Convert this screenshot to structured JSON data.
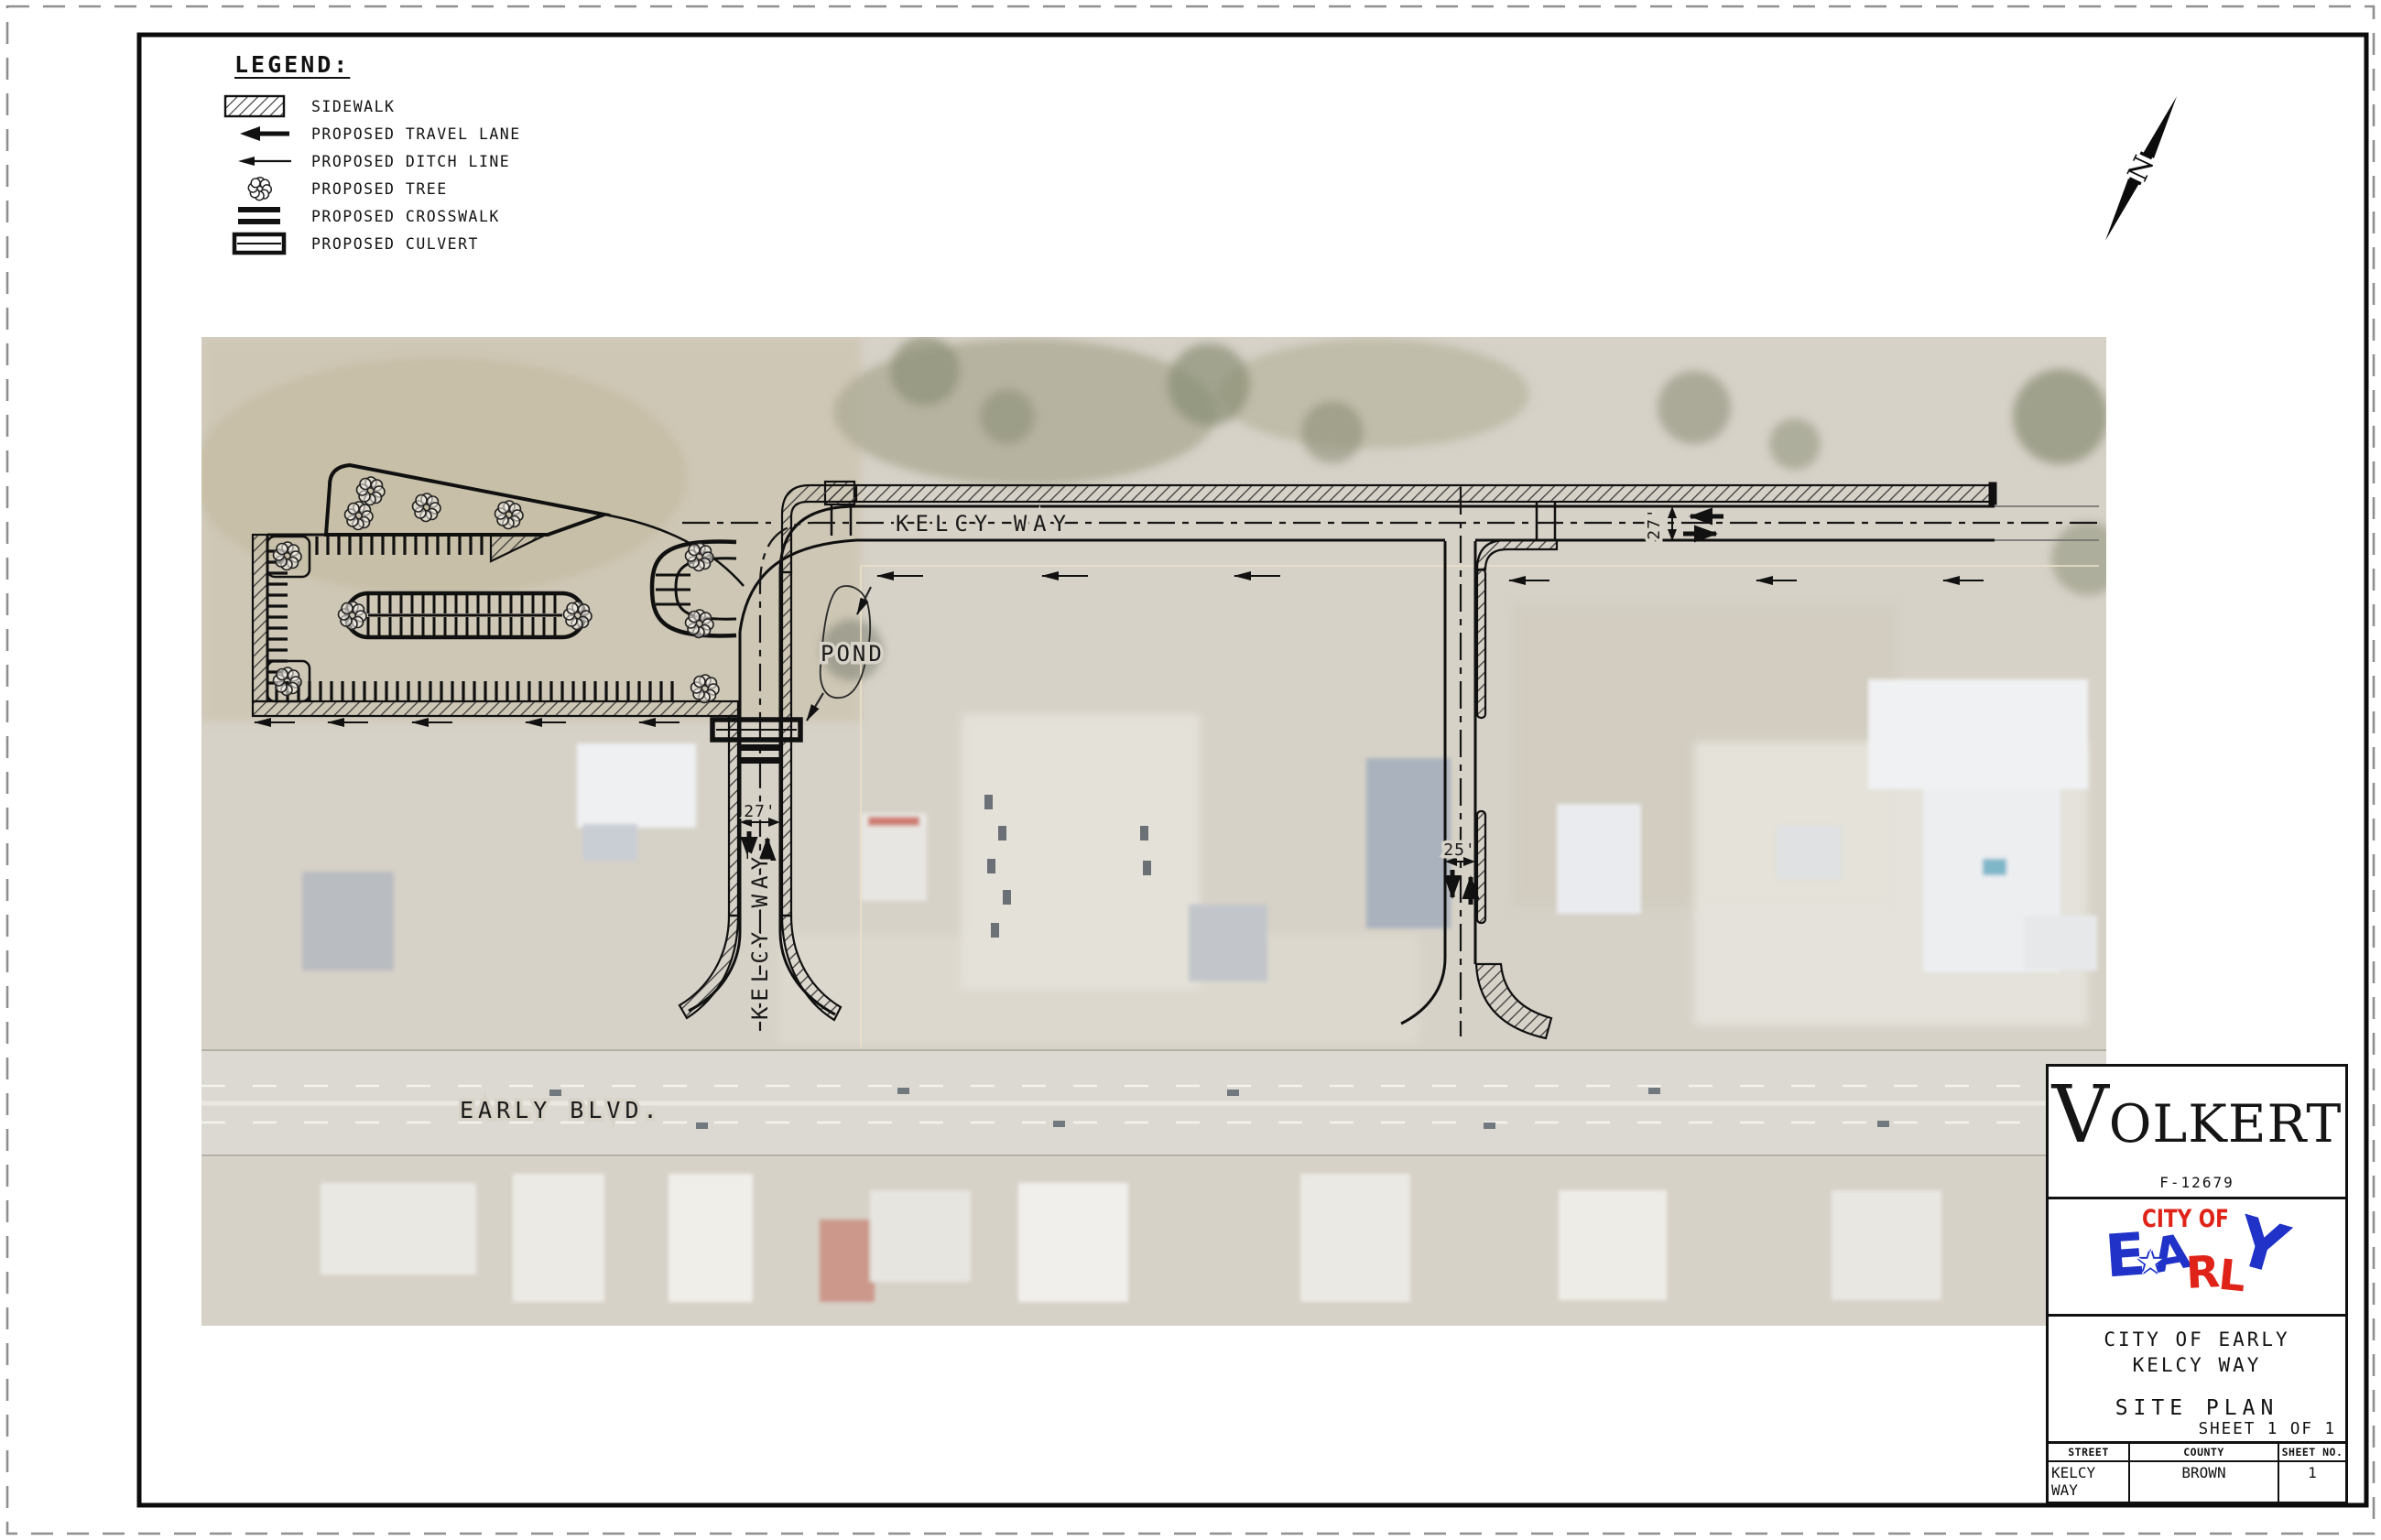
{
  "legend": {
    "title": "LEGEND:",
    "items": [
      {
        "id": "sidewalk",
        "label": "SIDEWALK"
      },
      {
        "id": "travel",
        "label": "PROPOSED TRAVEL LANE"
      },
      {
        "id": "ditch",
        "label": "PROPOSED DITCH LINE"
      },
      {
        "id": "tree",
        "label": "PROPOSED TREE"
      },
      {
        "id": "crosswalk",
        "label": "PROPOSED CROSSWALK"
      },
      {
        "id": "culvert",
        "label": "PROPOSED CULVERT"
      }
    ]
  },
  "north": {
    "label": "N"
  },
  "plan": {
    "labels": {
      "kelcy_top": "KELCY WAY",
      "kelcy_left": "KELCY WAY",
      "pond": "POND",
      "early_blvd": "EARLY BLVD.",
      "dim_left": "27'",
      "dim_top": "27'",
      "dim_right": "25'"
    }
  },
  "title_block": {
    "firm": "VOLKERT",
    "firm_v": "V",
    "firm_rest": "OLKERT",
    "registration": "F-12679",
    "city_logo": {
      "line1": "CITY OF",
      "star": "★",
      "letters": [
        {
          "char": "E",
          "color": "#2032c8"
        },
        {
          "char": "A",
          "color": "#2032c8"
        },
        {
          "char": "R",
          "color": "#e02318"
        },
        {
          "char": "L",
          "color": "#e02318"
        },
        {
          "char": "Y",
          "color": "#2032c8"
        }
      ]
    },
    "project_line1": "CITY OF EARLY",
    "project_line2": "KELCY WAY",
    "sheet_title": "SITE PLAN",
    "sheet_count": "SHEET 1 OF 1",
    "table": {
      "headers": [
        "STREET",
        "COUNTY",
        "SHEET NO."
      ],
      "values": [
        "KELCY WAY",
        "BROWN",
        "1"
      ]
    }
  },
  "colors": {
    "red": "#e02318",
    "blue": "#2032c8",
    "line": "#111111"
  }
}
